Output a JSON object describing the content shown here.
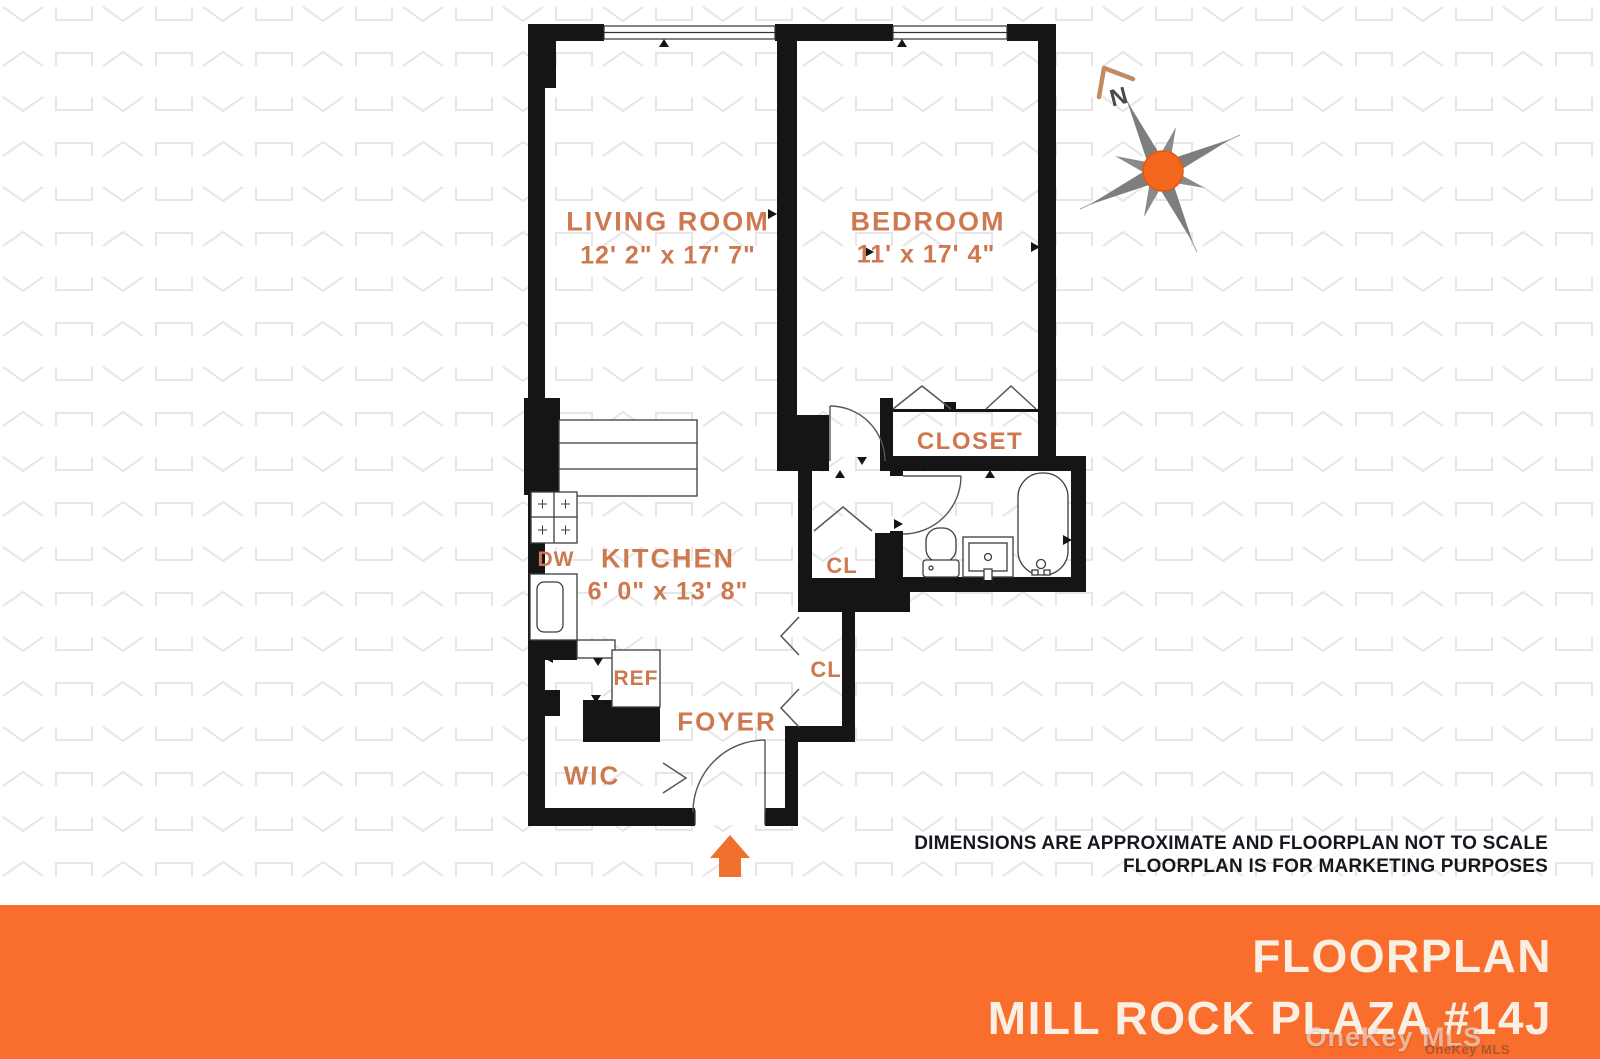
{
  "colors": {
    "banner_orange": "#F96D2D",
    "label_orange": "#CE7850",
    "wall_black": "#151515",
    "compass_orange": "#F2671D",
    "compass_gray": "#7E7E7E",
    "compass_north_arrow": "#C08B63",
    "entrance_arrow_orange": "#F2702E",
    "pattern_gray": "#E5E5E8",
    "banner_text": "#F9EFE3",
    "disclaimer_text": "#17171F"
  },
  "rooms": {
    "living_room": {
      "name": "LIVING ROOM",
      "dims": "12' 2\" x 17' 7\""
    },
    "bedroom": {
      "name": "BEDROOM",
      "dims": "11' x 17' 4\""
    },
    "kitchen": {
      "name": "KITCHEN",
      "dims": "6' 0\" x 13' 8\""
    },
    "closet": {
      "name": "CLOSET"
    },
    "foyer": {
      "name": "FOYER"
    },
    "wic": {
      "name": "WIC"
    },
    "hall_closet": {
      "name": "CL"
    },
    "foyer_closet": {
      "name": "CL"
    },
    "dishwasher": {
      "name": "DW"
    },
    "refrigerator": {
      "name": "REF"
    }
  },
  "compass": {
    "north": "N"
  },
  "icons": {
    "compass": "compass-rose",
    "entrance": "entrance-arrow"
  },
  "disclaimer": {
    "line1": "DIMENSIONS ARE APPROXIMATE AND FLOORPLAN NOT TO SCALE",
    "line2": "FLOORPLAN IS FOR MARKETING PURPOSES"
  },
  "banner": {
    "title": "FLOORPLAN",
    "subtitle": "MILL ROCK PLAZA #14J"
  },
  "watermark": {
    "primary": "OneKey MLS",
    "secondary": "OneKey MLS"
  }
}
